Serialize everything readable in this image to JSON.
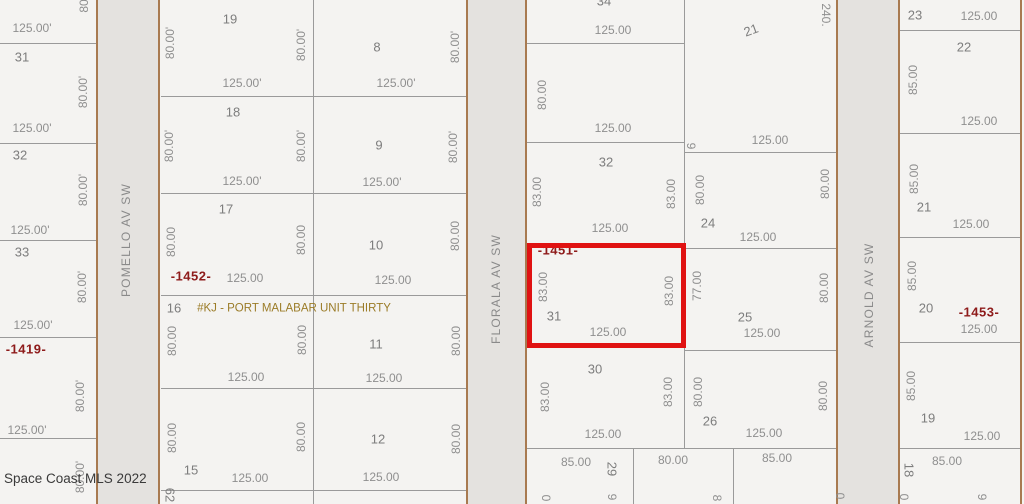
{
  "watermark": "Space Coast MLS 2022",
  "colors": {
    "background": "#f4f3f1",
    "street_fill": "#e4e2df",
    "street_edge": "#a87a50",
    "lot_line": "#9a9a9a",
    "dimension_text": "#8f8f8f",
    "lot_number_text": "#7d7d7d",
    "plat_ref_text": "#8e1b1b",
    "note_text": "#9b7c28",
    "highlight": "#e01212"
  },
  "highlight": {
    "x": 527,
    "y": 243,
    "w": 159,
    "h": 105
  },
  "streets": [
    {
      "name": "POMELLO AV SW",
      "x": 97,
      "w": 62,
      "lx": 126,
      "ly": 240
    },
    {
      "name": "FLORALA AV SW",
      "x": 468,
      "w": 58,
      "lx": 496,
      "ly": 289
    },
    {
      "name": "ARNOLD AV SW",
      "x": 838,
      "w": 61,
      "lx": 869,
      "ly": 295
    }
  ],
  "lines": [
    {
      "x": 0,
      "y": 43,
      "w": 96,
      "h": 1,
      "c": "gray"
    },
    {
      "x": 0,
      "y": 143,
      "w": 96,
      "h": 1,
      "c": "gray"
    },
    {
      "x": 0,
      "y": 240,
      "w": 96,
      "h": 1,
      "c": "gray"
    },
    {
      "x": 0,
      "y": 337,
      "w": 96,
      "h": 1,
      "c": "gray"
    },
    {
      "x": 0,
      "y": 438,
      "w": 96,
      "h": 1,
      "c": "gray"
    },
    {
      "x": 161,
      "y": 96,
      "w": 306,
      "h": 1,
      "c": "gray"
    },
    {
      "x": 161,
      "y": 193,
      "w": 306,
      "h": 1,
      "c": "gray"
    },
    {
      "x": 161,
      "y": 295,
      "w": 306,
      "h": 1,
      "c": "gray"
    },
    {
      "x": 161,
      "y": 388,
      "w": 306,
      "h": 1,
      "c": "gray"
    },
    {
      "x": 161,
      "y": 490,
      "w": 306,
      "h": 1,
      "c": "gray"
    },
    {
      "x": 313,
      "y": 0,
      "w": 1,
      "h": 504,
      "c": "gray"
    },
    {
      "x": 527,
      "y": 43,
      "w": 157,
      "h": 1,
      "c": "gray"
    },
    {
      "x": 527,
      "y": 142,
      "w": 158,
      "h": 1,
      "c": "gray"
    },
    {
      "x": 527,
      "y": 245,
      "w": 158,
      "h": 1,
      "c": "gray"
    },
    {
      "x": 527,
      "y": 347,
      "w": 158,
      "h": 1,
      "c": "gray"
    },
    {
      "x": 684,
      "y": 0,
      "w": 1,
      "h": 448,
      "c": "gray"
    },
    {
      "x": 685,
      "y": 152,
      "w": 152,
      "h": 1,
      "c": "gray"
    },
    {
      "x": 685,
      "y": 248,
      "w": 152,
      "h": 1,
      "c": "gray"
    },
    {
      "x": 685,
      "y": 350,
      "w": 152,
      "h": 1,
      "c": "gray"
    },
    {
      "x": 527,
      "y": 448,
      "w": 310,
      "h": 1,
      "c": "gray"
    },
    {
      "x": 633,
      "y": 448,
      "w": 1,
      "h": 56,
      "c": "gray"
    },
    {
      "x": 733,
      "y": 448,
      "w": 1,
      "h": 56,
      "c": "gray"
    },
    {
      "x": 900,
      "y": 30,
      "w": 121,
      "h": 1,
      "c": "gray"
    },
    {
      "x": 900,
      "y": 133,
      "w": 121,
      "h": 1,
      "c": "gray"
    },
    {
      "x": 900,
      "y": 237,
      "w": 121,
      "h": 1,
      "c": "gray"
    },
    {
      "x": 900,
      "y": 342,
      "w": 121,
      "h": 1,
      "c": "gray"
    },
    {
      "x": 900,
      "y": 448,
      "w": 121,
      "h": 1,
      "c": "gray"
    },
    {
      "x": 96,
      "y": 0,
      "w": 2,
      "h": 504,
      "c": "brown"
    },
    {
      "x": 158,
      "y": 0,
      "w": 2,
      "h": 504,
      "c": "brown"
    },
    {
      "x": 466,
      "y": 0,
      "w": 2,
      "h": 504,
      "c": "brown"
    },
    {
      "x": 525,
      "y": 0,
      "w": 2,
      "h": 504,
      "c": "brown"
    },
    {
      "x": 836,
      "y": 0,
      "w": 2,
      "h": 504,
      "c": "brown"
    },
    {
      "x": 898,
      "y": 0,
      "w": 2,
      "h": 504,
      "c": "brown"
    },
    {
      "x": 1020,
      "y": 0,
      "w": 2,
      "h": 504,
      "c": "brown"
    }
  ],
  "labels": [
    {
      "t": "80",
      "x": 84,
      "y": 6,
      "r": -90,
      "c": "dim"
    },
    {
      "t": "125.00'",
      "x": 32,
      "y": 28,
      "c": "dim"
    },
    {
      "t": "31",
      "x": 22,
      "y": 57,
      "c": "num"
    },
    {
      "t": "80.00'",
      "x": 83,
      "y": 92,
      "r": -90,
      "c": "dim"
    },
    {
      "t": "125.00'",
      "x": 32,
      "y": 128,
      "c": "dim"
    },
    {
      "t": "32",
      "x": 20,
      "y": 155,
      "c": "num"
    },
    {
      "t": "80.00'",
      "x": 83,
      "y": 190,
      "r": -90,
      "c": "dim"
    },
    {
      "t": "125.00'",
      "x": 30,
      "y": 230,
      "c": "dim"
    },
    {
      "t": "33",
      "x": 22,
      "y": 252,
      "c": "num"
    },
    {
      "t": "80.00'",
      "x": 82,
      "y": 287,
      "r": -90,
      "c": "dim"
    },
    {
      "t": "125.00'",
      "x": 33,
      "y": 325,
      "c": "dim"
    },
    {
      "t": "-1419-",
      "x": 26,
      "y": 349,
      "c": "ref"
    },
    {
      "t": "80.00'",
      "x": 80,
      "y": 396,
      "r": -90,
      "c": "dim"
    },
    {
      "t": "125.00'",
      "x": 27,
      "y": 430,
      "c": "dim"
    },
    {
      "t": "80.00'",
      "x": 80,
      "y": 477,
      "r": -90,
      "c": "dim"
    },
    {
      "t": "19",
      "x": 230,
      "y": 19,
      "c": "num"
    },
    {
      "t": "80.00'",
      "x": 170,
      "y": 43,
      "r": -90,
      "c": "dim"
    },
    {
      "t": "80.00'",
      "x": 301,
      "y": 45,
      "r": -90,
      "c": "dim"
    },
    {
      "t": "125.00'",
      "x": 242,
      "y": 83,
      "c": "dim"
    },
    {
      "t": "18",
      "x": 233,
      "y": 112,
      "c": "num"
    },
    {
      "t": "80.00'",
      "x": 169,
      "y": 146,
      "r": -90,
      "c": "dim"
    },
    {
      "t": "80.00'",
      "x": 301,
      "y": 146,
      "r": -90,
      "c": "dim"
    },
    {
      "t": "125.00'",
      "x": 242,
      "y": 181,
      "c": "dim"
    },
    {
      "t": "17",
      "x": 226,
      "y": 209,
      "c": "num"
    },
    {
      "t": "80.00",
      "x": 171,
      "y": 242,
      "r": -90,
      "c": "dim"
    },
    {
      "t": "80.00",
      "x": 301,
      "y": 240,
      "r": -90,
      "c": "dim"
    },
    {
      "t": "-1452-",
      "x": 191,
      "y": 276,
      "c": "ref"
    },
    {
      "t": "125.00",
      "x": 245,
      "y": 278,
      "c": "dim"
    },
    {
      "t": "16",
      "x": 174,
      "y": 308,
      "c": "num"
    },
    {
      "t": "#KJ - PORT MALABAR UNIT THIRTY",
      "x": 294,
      "y": 309,
      "c": "note"
    },
    {
      "t": "80.00",
      "x": 172,
      "y": 341,
      "r": -90,
      "c": "dim"
    },
    {
      "t": "80.00",
      "x": 302,
      "y": 340,
      "r": -90,
      "c": "dim"
    },
    {
      "t": "125.00",
      "x": 246,
      "y": 377,
      "c": "dim"
    },
    {
      "t": "80.00",
      "x": 172,
      "y": 438,
      "r": -90,
      "c": "dim"
    },
    {
      "t": "80.00",
      "x": 301,
      "y": 437,
      "r": -90,
      "c": "dim"
    },
    {
      "t": "15",
      "x": 191,
      "y": 470,
      "c": "num"
    },
    {
      "t": "125.00",
      "x": 250,
      "y": 478,
      "c": "dim"
    },
    {
      "t": "62",
      "x": 170,
      "y": 495,
      "r": 90,
      "c": "num"
    },
    {
      "t": "8",
      "x": 377,
      "y": 47,
      "c": "num"
    },
    {
      "t": "80.00'",
      "x": 455,
      "y": 47,
      "r": -90,
      "c": "dim"
    },
    {
      "t": "125.00'",
      "x": 396,
      "y": 83,
      "c": "dim"
    },
    {
      "t": "9",
      "x": 379,
      "y": 145,
      "c": "num"
    },
    {
      "t": "80.00'",
      "x": 453,
      "y": 147,
      "r": -90,
      "c": "dim"
    },
    {
      "t": "125.00'",
      "x": 382,
      "y": 182,
      "c": "dim"
    },
    {
      "t": "10",
      "x": 376,
      "y": 245,
      "c": "num"
    },
    {
      "t": "80.00",
      "x": 455,
      "y": 236,
      "r": -90,
      "c": "dim"
    },
    {
      "t": "125.00",
      "x": 393,
      "y": 280,
      "c": "dim"
    },
    {
      "t": "11",
      "x": 376,
      "y": 344,
      "c": "num"
    },
    {
      "t": "80.00",
      "x": 456,
      "y": 341,
      "r": -90,
      "c": "dim"
    },
    {
      "t": "125.00",
      "x": 384,
      "y": 378,
      "c": "dim"
    },
    {
      "t": "12",
      "x": 378,
      "y": 439,
      "c": "num"
    },
    {
      "t": "80.00",
      "x": 456,
      "y": 439,
      "r": -90,
      "c": "dim"
    },
    {
      "t": "125.00",
      "x": 381,
      "y": 477,
      "c": "dim"
    },
    {
      "t": "34",
      "x": 604,
      "y": 1,
      "c": "num"
    },
    {
      "t": "125.00",
      "x": 613,
      "y": 30,
      "c": "dim"
    },
    {
      "t": "80.00",
      "x": 542,
      "y": 95,
      "r": -90,
      "c": "dim"
    },
    {
      "t": "125.00",
      "x": 613,
      "y": 128,
      "c": "dim"
    },
    {
      "t": "32",
      "x": 606,
      "y": 162,
      "c": "num"
    },
    {
      "t": "83.00",
      "x": 537,
      "y": 192,
      "r": -90,
      "c": "dim"
    },
    {
      "t": "83.00",
      "x": 671,
      "y": 194,
      "r": -90,
      "c": "dim"
    },
    {
      "t": "125.00",
      "x": 610,
      "y": 228,
      "c": "dim"
    },
    {
      "t": "-1451-",
      "x": 558,
      "y": 250,
      "c": "ref"
    },
    {
      "t": "83.00",
      "x": 543,
      "y": 287,
      "r": -90,
      "c": "dim"
    },
    {
      "t": "83.00",
      "x": 669,
      "y": 291,
      "r": -90,
      "c": "dim"
    },
    {
      "t": "31",
      "x": 554,
      "y": 316,
      "c": "num"
    },
    {
      "t": "125.00",
      "x": 608,
      "y": 332,
      "c": "dim"
    },
    {
      "t": "30",
      "x": 595,
      "y": 369,
      "c": "num"
    },
    {
      "t": "83.00",
      "x": 545,
      "y": 397,
      "r": -90,
      "c": "dim"
    },
    {
      "t": "83.00",
      "x": 668,
      "y": 392,
      "r": -90,
      "c": "dim"
    },
    {
      "t": "125.00",
      "x": 603,
      "y": 434,
      "c": "dim"
    },
    {
      "t": "85.00",
      "x": 576,
      "y": 462,
      "c": "dim"
    },
    {
      "t": "29",
      "x": 612,
      "y": 469,
      "r": 90,
      "c": "num"
    },
    {
      "t": "80.00",
      "x": 673,
      "y": 460,
      "c": "dim"
    },
    {
      "t": "85.00",
      "x": 777,
      "y": 458,
      "c": "dim"
    },
    {
      "t": "0",
      "x": 546,
      "y": 498,
      "r": 90,
      "c": "dim"
    },
    {
      "t": "9",
      "x": 612,
      "y": 497,
      "r": 90,
      "c": "dim"
    },
    {
      "t": "8",
      "x": 717,
      "y": 498,
      "r": 90,
      "c": "dim"
    },
    {
      "t": "0",
      "x": 840,
      "y": 496,
      "r": 90,
      "c": "dim"
    },
    {
      "t": "21",
      "x": 751,
      "y": 30,
      "r": -20,
      "c": "num"
    },
    {
      "t": "240.",
      "x": 826,
      "y": 15,
      "r": 90,
      "c": "dim"
    },
    {
      "t": "9",
      "x": 691,
      "y": 146,
      "r": 90,
      "c": "dim"
    },
    {
      "t": "125.00",
      "x": 770,
      "y": 140,
      "c": "dim"
    },
    {
      "t": "80.00",
      "x": 700,
      "y": 190,
      "r": -90,
      "c": "dim"
    },
    {
      "t": "80.00",
      "x": 825,
      "y": 184,
      "r": -90,
      "c": "dim"
    },
    {
      "t": "24",
      "x": 708,
      "y": 223,
      "c": "num"
    },
    {
      "t": "125.00",
      "x": 758,
      "y": 237,
      "c": "dim"
    },
    {
      "t": "77.00",
      "x": 697,
      "y": 286,
      "r": -90,
      "c": "dim"
    },
    {
      "t": "80.00",
      "x": 824,
      "y": 288,
      "r": -90,
      "c": "dim"
    },
    {
      "t": "25",
      "x": 745,
      "y": 317,
      "c": "num"
    },
    {
      "t": "125.00",
      "x": 762,
      "y": 333,
      "c": "dim"
    },
    {
      "t": "80.00",
      "x": 698,
      "y": 392,
      "r": -90,
      "c": "dim"
    },
    {
      "t": "80.00",
      "x": 823,
      "y": 396,
      "r": -90,
      "c": "dim"
    },
    {
      "t": "26",
      "x": 710,
      "y": 421,
      "c": "num"
    },
    {
      "t": "125.00",
      "x": 764,
      "y": 433,
      "c": "dim"
    },
    {
      "t": "23",
      "x": 915,
      "y": 15,
      "c": "num"
    },
    {
      "t": "125.00",
      "x": 979,
      "y": 16,
      "c": "dim"
    },
    {
      "t": "22",
      "x": 964,
      "y": 47,
      "c": "num"
    },
    {
      "t": "85.00",
      "x": 913,
      "y": 80,
      "r": -90,
      "c": "dim"
    },
    {
      "t": "125.00",
      "x": 979,
      "y": 121,
      "c": "dim"
    },
    {
      "t": "85.00",
      "x": 914,
      "y": 179,
      "r": -90,
      "c": "dim"
    },
    {
      "t": "21",
      "x": 924,
      "y": 207,
      "c": "num"
    },
    {
      "t": "125.00",
      "x": 971,
      "y": 224,
      "c": "dim"
    },
    {
      "t": "85.00",
      "x": 912,
      "y": 276,
      "r": -90,
      "c": "dim"
    },
    {
      "t": "20",
      "x": 926,
      "y": 308,
      "c": "num"
    },
    {
      "t": "-1453-",
      "x": 979,
      "y": 312,
      "c": "ref"
    },
    {
      "t": "125.00",
      "x": 979,
      "y": 329,
      "c": "dim"
    },
    {
      "t": "85.00",
      "x": 911,
      "y": 386,
      "r": -90,
      "c": "dim"
    },
    {
      "t": "19",
      "x": 928,
      "y": 418,
      "c": "num"
    },
    {
      "t": "125.00",
      "x": 982,
      "y": 436,
      "c": "dim"
    },
    {
      "t": "85.00",
      "x": 947,
      "y": 461,
      "c": "dim"
    },
    {
      "t": "18",
      "x": 909,
      "y": 470,
      "r": 90,
      "c": "num"
    },
    {
      "t": "0",
      "x": 904,
      "y": 497,
      "r": 90,
      "c": "dim"
    },
    {
      "t": "9",
      "x": 982,
      "y": 497,
      "r": 90,
      "c": "dim"
    }
  ]
}
